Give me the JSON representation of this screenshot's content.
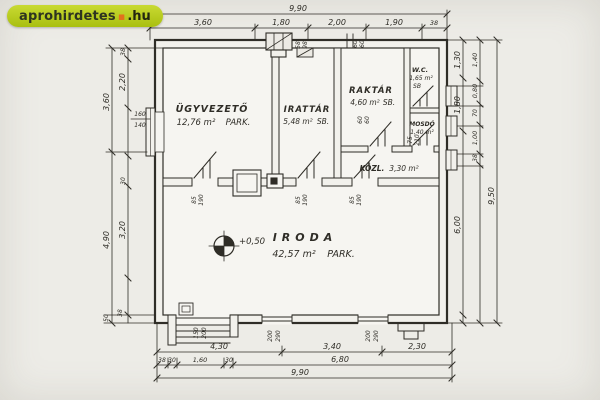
{
  "watermark": {
    "name": "aprohirdetes",
    "dot": "▪",
    "tld": ".hu"
  },
  "colors": {
    "paper": "#edecE7",
    "ink": "#2f2d27",
    "wm_bg": "#b9cf20",
    "wm_dot": "#e2711d"
  },
  "rooms": {
    "ugyvezeto": {
      "name": "ÜGYVEZETŐ",
      "area": "12,76 m²",
      "note": "PARK."
    },
    "irattar": {
      "name": "IRATTÁR",
      "area": "5,48 m²",
      "note": "SB."
    },
    "raktar": {
      "name": "RAKTÁR",
      "area": "4,60 m²",
      "note": "SB."
    },
    "wc": {
      "name": "W.C.",
      "area": "1,65 m²",
      "note": "SB"
    },
    "mosdo": {
      "name": "MOSDÓ",
      "area": "1,40 m²"
    },
    "kozl": {
      "name": "KÖZL.",
      "area": "3,30 m²"
    },
    "iroda": {
      "name": "IRODA",
      "area": "42,57 m²",
      "note": "PARK."
    }
  },
  "level_mark": "+0,50",
  "dims": {
    "top_total": "9,90",
    "top_segments": [
      "3,60",
      "1,80",
      "2,00",
      "1,90",
      "38"
    ],
    "bottom_row1": [
      "4,30",
      "3,40",
      "2,30"
    ],
    "bottom_row2": [
      "38",
      "30",
      "1,60",
      "30",
      "6,80"
    ],
    "bottom_total": "9,90",
    "left_outer": [
      "3,60",
      "4,90"
    ],
    "left_inner": [
      "38",
      "2,20",
      "3,20",
      "30"
    ],
    "left_bottom": [
      "38",
      "50"
    ],
    "left_window": [
      "160",
      "140"
    ],
    "right_inner": [
      "1,30",
      "1,80",
      "6,00"
    ],
    "right_outer": [
      "1,40",
      "0,80",
      "70",
      "1,00",
      "38"
    ],
    "right_total": "9,50",
    "door_size": [
      "85",
      "190"
    ],
    "kozl_door": [
      "75",
      "210"
    ],
    "entrance_size": [
      "150",
      "200"
    ],
    "window_size": [
      "200",
      "290"
    ],
    "chimney_size": [
      "58",
      "98"
    ],
    "vent_size": [
      "60",
      "60"
    ]
  }
}
